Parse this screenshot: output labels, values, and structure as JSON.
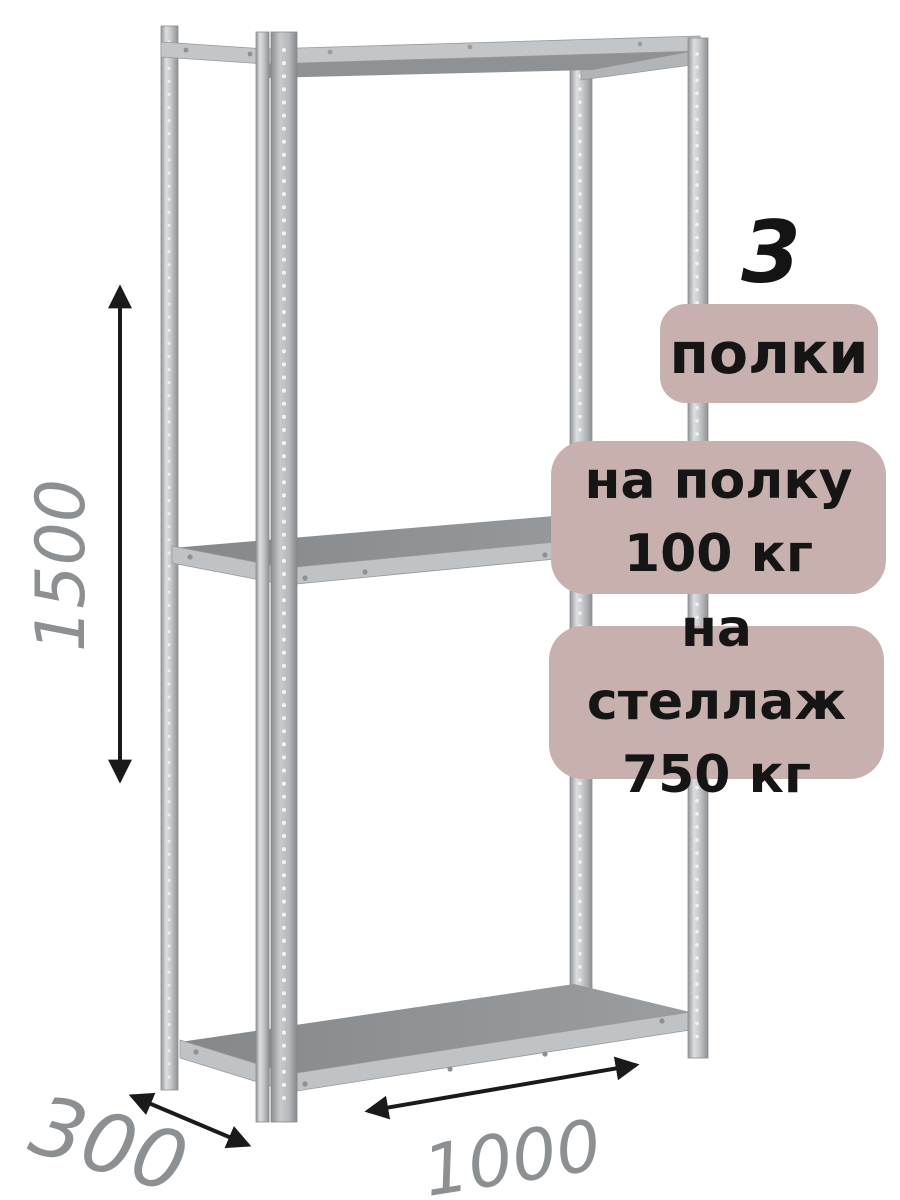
{
  "image": {
    "description": "Металлический стеллаж (3D-рендер) на белом фоне с размерными стрелками и рекламными плашками",
    "background_color": "#ffffff"
  },
  "dimensions": {
    "height_mm": "1500",
    "depth_mm": "300",
    "width_mm": "1000"
  },
  "badges": {
    "shelf_count_number": "3",
    "shelf_count_label": "полки",
    "shelf_load_line1": "на полку",
    "shelf_load_line2": "100 кг",
    "rack_load_line1": "на стеллаж",
    "rack_load_line2": "750 кг"
  },
  "colors": {
    "badge_background": "#c8b0ae",
    "badge_text": "#151515",
    "dimension_label": "#8d9092",
    "arrow": "#1a1a1a",
    "metal_light": "#c6c9cc",
    "metal_mid": "#b2b5b8",
    "metal_dark": "#8e9194"
  }
}
